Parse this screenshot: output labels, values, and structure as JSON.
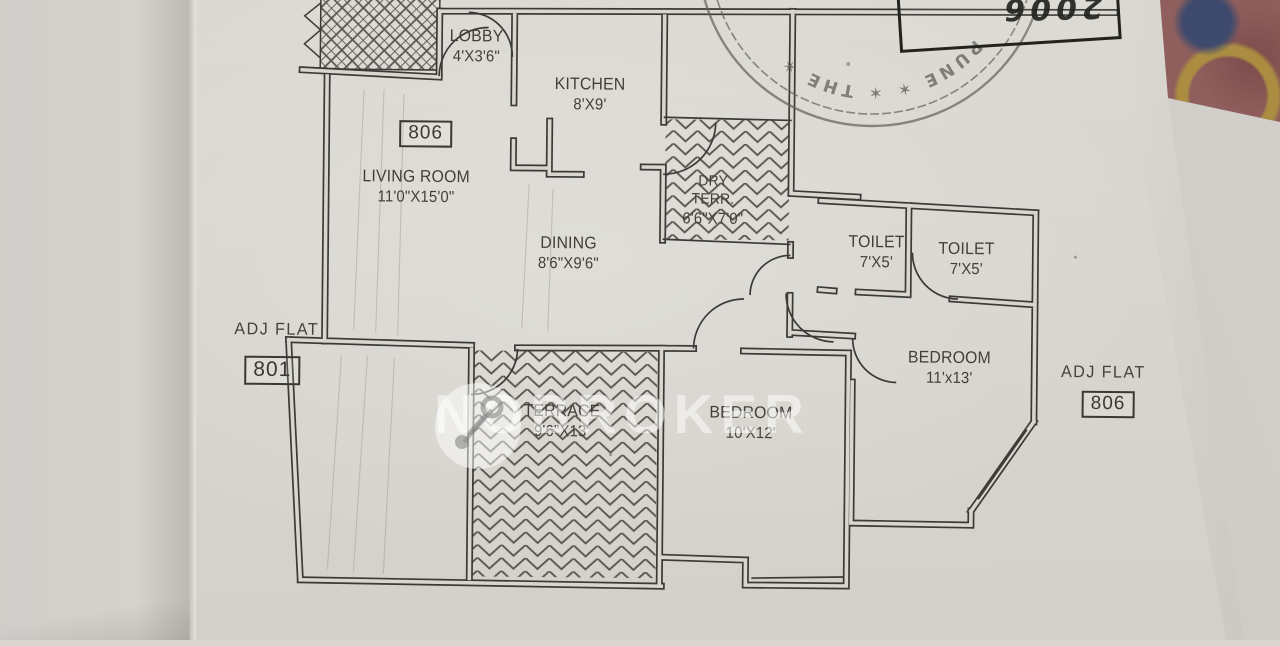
{
  "plan": {
    "unit_number": "806",
    "rooms": [
      {
        "name": "LOBBY",
        "size": "4'X3'6\""
      },
      {
        "name": "KITCHEN",
        "size": "8'X9'"
      },
      {
        "name": "LIVING ROOM",
        "size": "11'0\"X15'0\""
      },
      {
        "name": "DINING",
        "size": "8'6\"X9'6\""
      },
      {
        "name": "DRY TERR.",
        "size": "6'6\"X7'0\""
      },
      {
        "name": "TOILET",
        "size": "7'X5'"
      },
      {
        "name": "TOILET",
        "size": "7'X5'"
      },
      {
        "name": "BEDROOM",
        "size": "11'x13'"
      },
      {
        "name": "BEDROOM",
        "size": "10'X12'"
      },
      {
        "name": "TERRACE",
        "size": "9'6\"X13'"
      }
    ],
    "adjacent_flats": [
      {
        "label": "ADJ FLAT",
        "number": "801"
      },
      {
        "label": "ADJ FLAT",
        "number": "806"
      }
    ]
  },
  "stamp": {
    "text": "PUNE ✶ ✶ THE ✶"
  },
  "handwriting": {
    "number": "2006"
  },
  "watermark": {
    "brand": "NOBROKER"
  }
}
